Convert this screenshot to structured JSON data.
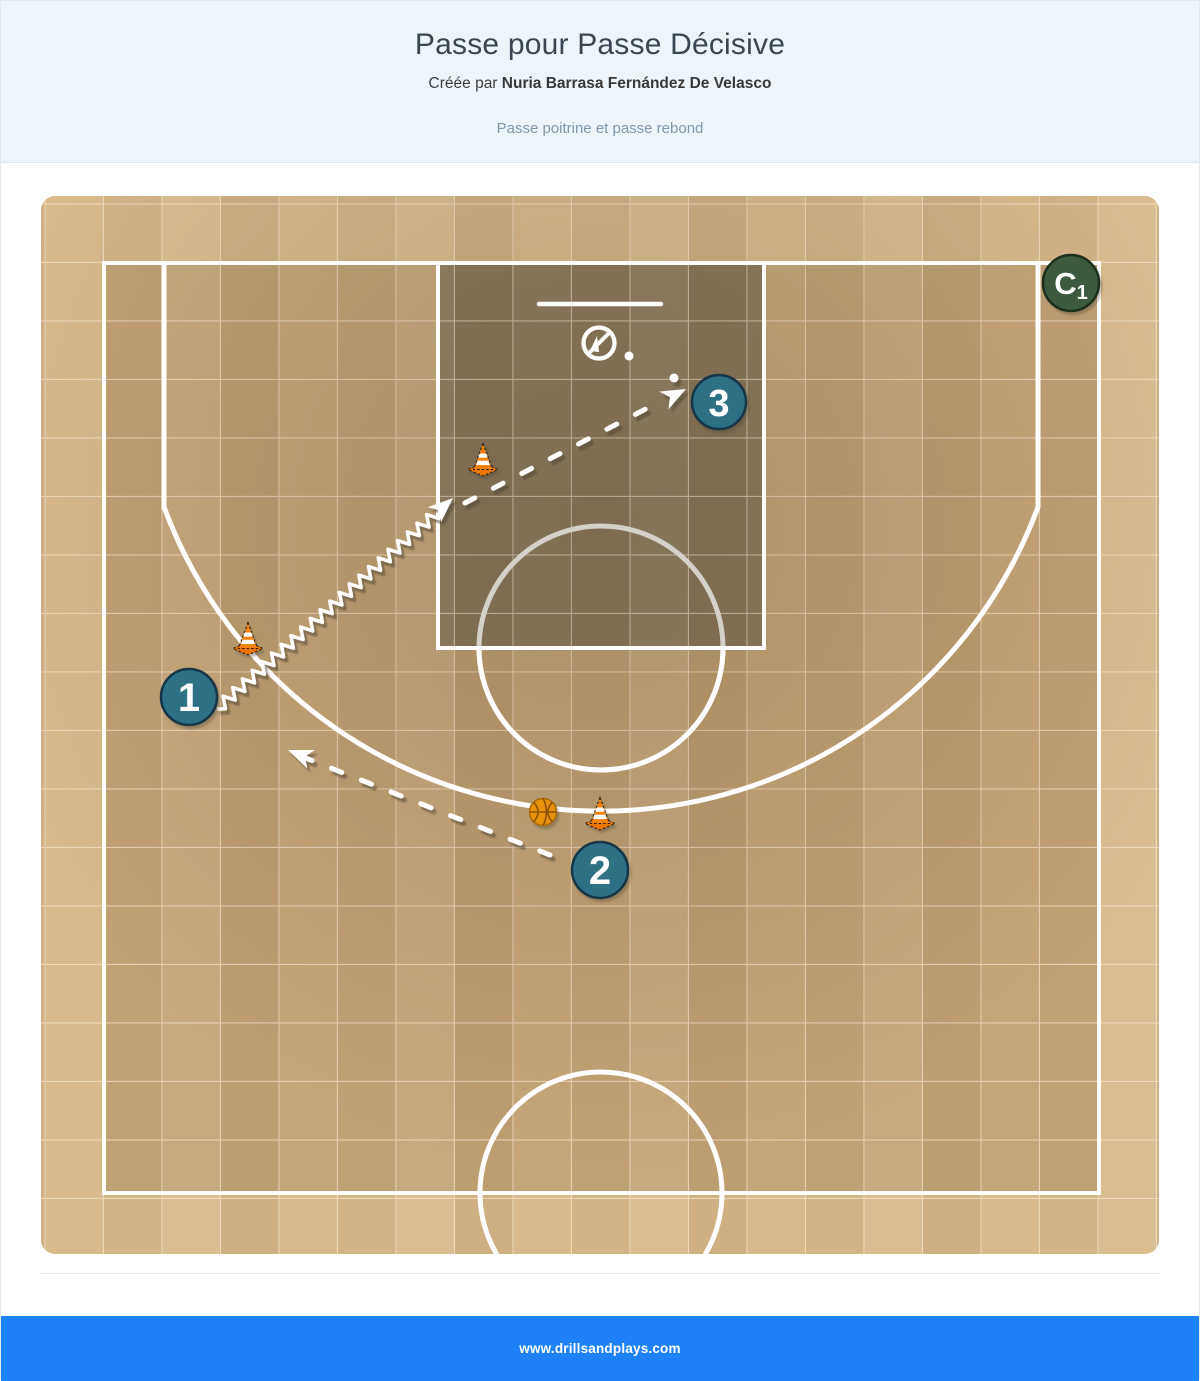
{
  "header": {
    "title": "Passe pour Passe Décisive",
    "byline_prefix": "Créée par ",
    "author": "Nuria Barrasa Fernández De Velasco",
    "description": "Passe poitrine et passe rebond"
  },
  "diagram": {
    "players": [
      {
        "label": "1"
      },
      {
        "label": "2"
      },
      {
        "label": "3"
      }
    ],
    "coach": {
      "label": "C",
      "sub": "1"
    },
    "cones_count": 3,
    "balls_count": 1
  },
  "footer": {
    "website": "www.drillsandplays.com"
  },
  "colors": {
    "header_bg": "#edf5fa",
    "footer_bg": "#1d82f7",
    "player_fill": "#2d6f84",
    "coach_fill": "#3d5a41",
    "cone_orange": "#f5820b",
    "ball_orange": "#e9930e",
    "court_light": "#d8ba8c",
    "court_inner": "#c5a678",
    "paint_dark": "#8b7b5f"
  }
}
